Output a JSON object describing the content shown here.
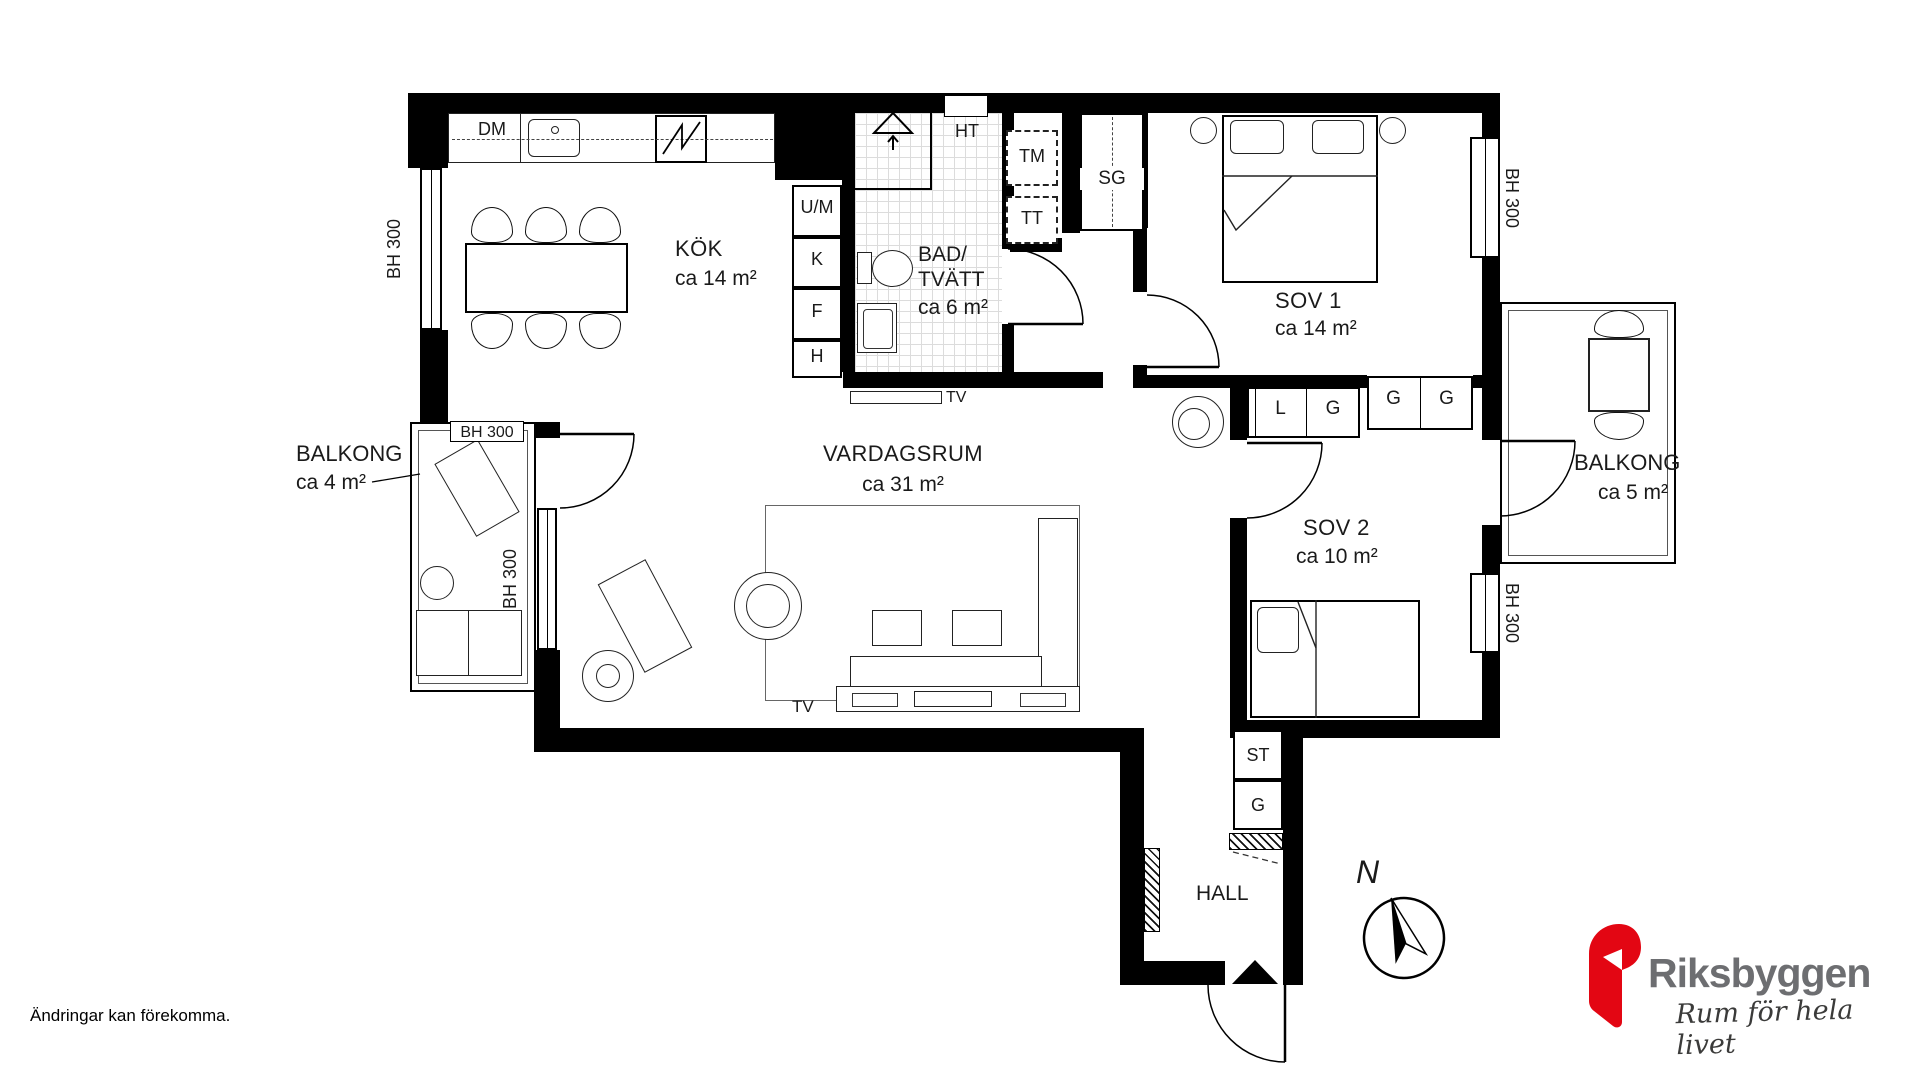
{
  "plan": {
    "rooms": {
      "kok": {
        "name": "KÖK",
        "area": "ca 14 m²"
      },
      "bad": {
        "name_line1": "BAD/",
        "name_line2": "TVÄTT",
        "area": "ca 6 m²"
      },
      "vardagsrum": {
        "name": "VARDAGSRUM",
        "area": "ca 31 m²"
      },
      "sov1": {
        "name": "SOV 1",
        "area": "ca 14 m²"
      },
      "sov2": {
        "name": "SOV 2",
        "area": "ca 10 m²"
      },
      "balkong_left": {
        "name": "BALKONG",
        "area": "ca 4 m²"
      },
      "balkong_right": {
        "name": "BALKONG",
        "area": "ca 5 m²"
      },
      "hall": {
        "name": "HALL"
      }
    },
    "fixtures": {
      "dm": "DM",
      "ht": "HT",
      "tm": "TM",
      "tt": "TT",
      "sg": "SG",
      "um": "U/M",
      "k": "K",
      "f": "F",
      "h": "H",
      "tv": "TV",
      "l": "L",
      "g": "G",
      "st": "ST"
    },
    "window_label": "BH 300",
    "north_label": "N"
  },
  "footer": {
    "disclaimer": "Ändringar kan förekomma."
  },
  "logo": {
    "name": "Riksbyggen",
    "tagline": "Rum för hela livet",
    "brand_red": "#e30613",
    "brand_gray": "#6d6e71"
  }
}
